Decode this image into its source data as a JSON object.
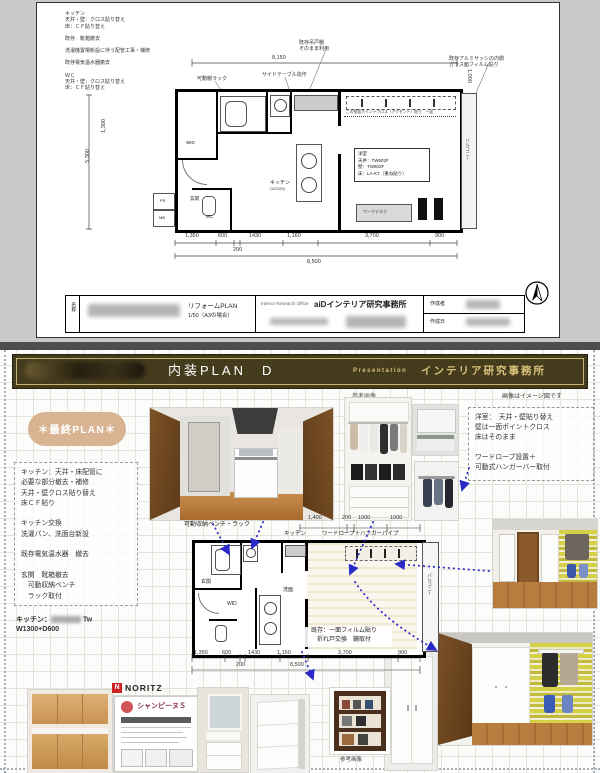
{
  "top_sheet": {
    "notes": [
      "キッチン",
      "天井・壁：クロス貼り替え",
      "床：ＣＦ貼り替え",
      "",
      "既存　靴箱撤去",
      "",
      "洗濯機置場新設に伴う配管工事・補修",
      "",
      "既存電気温水器撤去",
      "",
      "ＷＣ",
      "天井・壁：クロス貼り替え",
      "床：ＣＦ貼り替え"
    ],
    "leader_labels": {
      "rack": "可動棚ラック",
      "side_table": "サイドテーブル造作",
      "hanging_1": "既存吊戸棚",
      "hanging_2": "そのまま利用",
      "sash_1": "既存アルミサッシの内側",
      "sash_2": "ガラス面フィルム貼り"
    },
    "plan": {
      "kitchen": "キッチン",
      "kitchen_sub": "(W2550)",
      "accent_note": "この壁面ポイントクロス（アクセント）貼り　一面",
      "room_info": [
        "洋室",
        "天井：TW602F",
        "壁：TW602F",
        "床：LA-KT（重ね貼り）"
      ],
      "desk": "ワークデスク",
      "wc": "WC",
      "wid": "WID",
      "genkan": "玄関",
      "balcony": "バルコニー",
      "ps": "PS",
      "mb": "MB"
    },
    "dims": {
      "top_total": "8,150",
      "right_v": "1,000",
      "left_v1": "5,300",
      "left_v2": "1,300",
      "bottom_row": [
        "1,350",
        "600",
        "200",
        "1430",
        "1,160",
        "3,700",
        "900"
      ],
      "bottom_total": "8,500"
    },
    "titleblock": {
      "name_label": "名称",
      "plan_title": "リフォームPLAN",
      "scale": "1/50（A3の場合）",
      "office_en": "Interior Research Office",
      "office_jp": "aiDインテリア研究事務所",
      "author_label": "作成者",
      "date_label": "作成日"
    }
  },
  "presentation": {
    "header": {
      "title": "内装PLAN　D",
      "tag": "Presentation",
      "office": "インテリア研究事務所"
    },
    "image_note": "画像はイメージ図です",
    "ref_image": "参考画像",
    "final_plan": "＊最終PLAN＊",
    "work_list": [
      "キッチン：天井・床配管に",
      "必要な部分撤去・補修",
      "天井・壁クロス貼り替え",
      "床ＣＦ貼り",
      "",
      "キッチン交換",
      "洗濯パン、洗面台新設",
      "",
      "既存電気温水器　撤去",
      "",
      "玄関　靴箱撤去",
      "　可動収納ベンチ",
      "　ラック取付"
    ],
    "room_notes": [
      "洋室：　天井・壁貼り替え",
      "壁は一面ポイントクロス",
      "床はそのまま",
      "",
      "ワードローブ設置＋",
      "可動式ハンガーバー取付"
    ],
    "kitchen_spec": {
      "prefix": "キッチン：",
      "suffix": "Tw",
      "line2": "W1300+D600"
    },
    "noritz": "NORITZ",
    "catalog_title": "シャンピーヌＳ",
    "plan_labels": {
      "kitchen": "キッチン",
      "wardrobe": "ワードローブ＋ハンガーパイプ",
      "bench": "可動収納ベンチ・ラック",
      "genkan": "玄関",
      "wid": "WID",
      "senmen": "洗面",
      "balcony": "バルコニー",
      "window_note1": "既存：一面フィルム貼り",
      "window_note2": "折れ戸交換　鏡取付"
    },
    "dims_top": [
      "1,400",
      "200",
      "1000",
      "1000"
    ],
    "dims_bottom": [
      "1,350",
      "600",
      "200",
      "1430",
      "1,160",
      "3,700",
      "900"
    ],
    "dims_total": "8,500",
    "shelf_caption": "参考画像"
  },
  "colors": {
    "header_olive": "#453b1d",
    "accent_gold": "#c9b172",
    "pill_tan": "#d8b492",
    "arrow_blue": "#2a2ac8",
    "noritz_red": "#cc2222"
  }
}
